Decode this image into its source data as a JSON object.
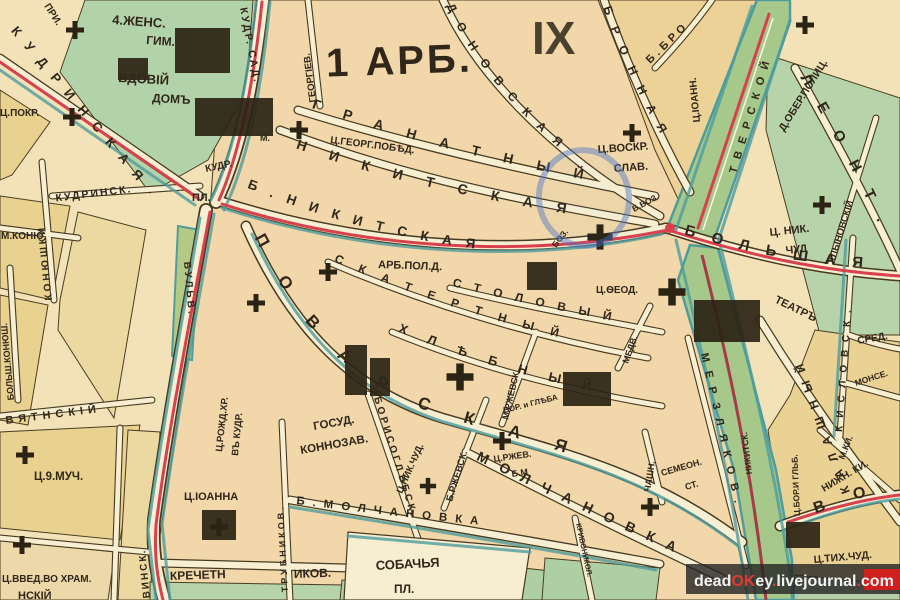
{
  "map": {
    "sheet_number": "IX",
    "district_title": "1 АРБ.",
    "colors": {
      "main_road_red": "#d9404d",
      "boulevard_green": "#a6c98b",
      "park_green": "#b2d3aa",
      "block_tan": "#f1d7a9",
      "block_yellow": "#e9d192",
      "street_edge_teal": "#4f9c9c",
      "ink": "#2f2718",
      "annotation_blue": "#4a74c8",
      "watermark_red": "#cf1f1f"
    }
  },
  "streets": {
    "kudrinskaya": "КУДРИНСКАЯ",
    "kudrinsk_flat": "КУДРИНСК.",
    "kudr": "КУДР.",
    "pl": "ПЛ.",
    "kudr_sad": "КУДР. САД.",
    "georgievsky": "ГЕОРГIЕВ.",
    "pri": "ПРИ.",
    "granatny": "ГРАНАТНЫЙ",
    "m_nikitskaya": "НИКИТСКАЯ",
    "m_label": "М.",
    "b_nikitskaya": "Б.НИКИТСКАЯ",
    "bolshaya": "БОЛЬШАЯ",
    "spiridonovskaya": "ДОНОВСКАЯ",
    "bronnaya": "БРОННАЯ",
    "b_bro": "Б.БРО",
    "tverskoy": "ТВЕРСКОЙ",
    "leontyevsky": "ЛЕОНТ.",
    "hlynovsky": "ХЛЫНОВСКIЙ",
    "kislovsky": "КИСЛОВСК.",
    "sredny": "СРЕД.",
    "monse": "МОНСЕ.",
    "m_ki": "М.КИ.",
    "nizhn_ki": "НИЖН. КИ.",
    "kalashny": "КАЛАШНЫЙ",
    "vozdvizhenka": "ВО",
    "povarskaya": "ПОВАРСКАЯ",
    "skatertny": "СКАТЕРТНЫЙ",
    "stolovy": "СТОЛОВЫЙ",
    "khlebny": "ХЛѢБНЫЙ",
    "medvezhy": "МЕДВ.",
    "m_rzhevsky": "М.РЖЕВСК.",
    "b_rzhevsky": "Б.РЖЕВСК.",
    "merzlyakovsky": "МЕРЗЛЯКОВ.",
    "nikitsky_blvd": "НИКИТСК.",
    "borisoglebsky": "БОРИСОГЛѢБСК.",
    "b_molchanovka": "Б.МОЛЧАНОВКА",
    "molchanovka": "МОЛЧАНОВКА",
    "sobachya": "СОБАЧЬЯ",
    "sobachya_pl": "ПЛ.",
    "krechetn": "КРЕЧЕТН",
    "ikov": "ИКОВ.",
    "trubnikovsky": "ТРУБНИКОВ.",
    "krivonikolsky": "КРИВОНИКОЛ.",
    "novinsky": "ВИНСК.",
    "bulv": "БУЛЬВ.",
    "devyatinsky": "ВЯТНСКIЙ",
    "nsky": "НСКIЙ",
    "konyushki": "КОНЮШКИ",
    "bolsh_konyush": "БОЛЬШ.КОНЮШ.",
    "m_konyu": "М.КОНЮ",
    "chashn": "ЧАШН."
  },
  "places": {
    "gymnasium_line1": "4.ЖЕНС.",
    "gymnasium_line2": "ГИМ.",
    "vdoviy_line1": "ВДОВIЙ",
    "vdoviy_line2": "ДОМЪ",
    "c_pokr": "Ц.ПОКР.",
    "c_georg_pobed": "Ц.ГЕОРГ.ПОБѢД.",
    "c_voskr_line1": "Ц.ВОСКР.",
    "c_voskr_line2": "СЛАВ.",
    "c_ioann": "Ц.IОАНН.",
    "ober_polic": "Д.ОБЕР.ПОЛИЦ.",
    "c_nik_chud_line1": "Ц. НИК.",
    "c_nik_chud_line2": "ЧУД",
    "teatr": "ТЕАТРЪ",
    "arb_pol_d": "АРБ.ПОЛ.Д.",
    "boz": "БОЗ.",
    "b_voz": "Б.ВОЗ.",
    "c_feod": "Ц.ѲЕОД.",
    "c_rozhd_line1": "Ц.РОЖД.ХР.",
    "c_rozhd_line2": "ВЪ КУДР.",
    "c_9much": "Ц.9.МУЧ.",
    "c_vved": "Ц.ВВЕД.ВО ХРАМ.",
    "c_ioanna": "Ц.IОАННА",
    "gosud_line1": "ГОСУД.",
    "gosud_line2": "КОННОЗАВ.",
    "c_nik_chud_center": "Ц.НИК.ЧУД.",
    "c_rzhev_line1": "Ц.РЖЕВ.",
    "c_rzhev_line2": "Б.М",
    "bor_i_gleba": "БОР. и ГЛѢБА",
    "semeon_line1": "СЕМЕОН.",
    "semeon_line2": "СТ.",
    "c_bor_glb": "Ц.БОР.И ГЛЬБ.",
    "c_tih_chud": "Ц.ТИХ.ЧУД."
  },
  "watermark": {
    "parts": [
      "dead",
      "OK",
      "ey",
      ".",
      "livejournal",
      ".",
      "com"
    ]
  }
}
